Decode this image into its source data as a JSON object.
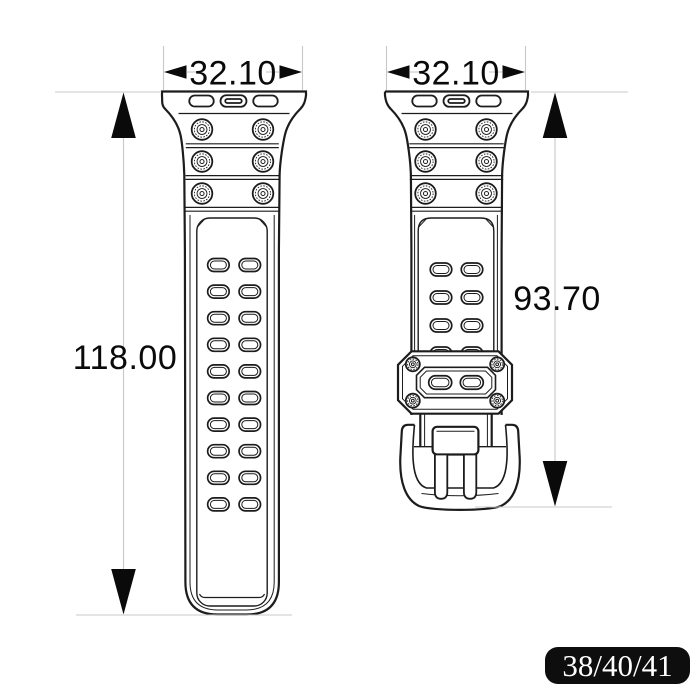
{
  "dimensions": {
    "left_width": "32.10",
    "right_width": "32.10",
    "left_length": "118.00",
    "right_length": "93.70"
  },
  "size_badge": {
    "label": "38/40/41",
    "background": "#0e0e0e",
    "text_color": "#ffffff"
  },
  "drawing": {
    "description": "Two-piece watch strap technical dimension drawing",
    "left_strap": {
      "adapter_slots": 3,
      "screw_rows": 3,
      "screws_per_row": 2,
      "hole_rows": 10,
      "holes_per_row": 2
    },
    "right_strap": {
      "adapter_slots": 3,
      "screw_rows": 3,
      "screws_per_row": 2,
      "hole_rows": 3,
      "partial_hole_rows": 1,
      "holes_per_row": 2,
      "keeper_screws": 4,
      "keeper_holes": 2
    },
    "colors": {
      "outline": "#1c1c1c",
      "dim_line": "#c8c8c8",
      "dim_text": "#0a0a0a",
      "background": "#ffffff"
    }
  }
}
